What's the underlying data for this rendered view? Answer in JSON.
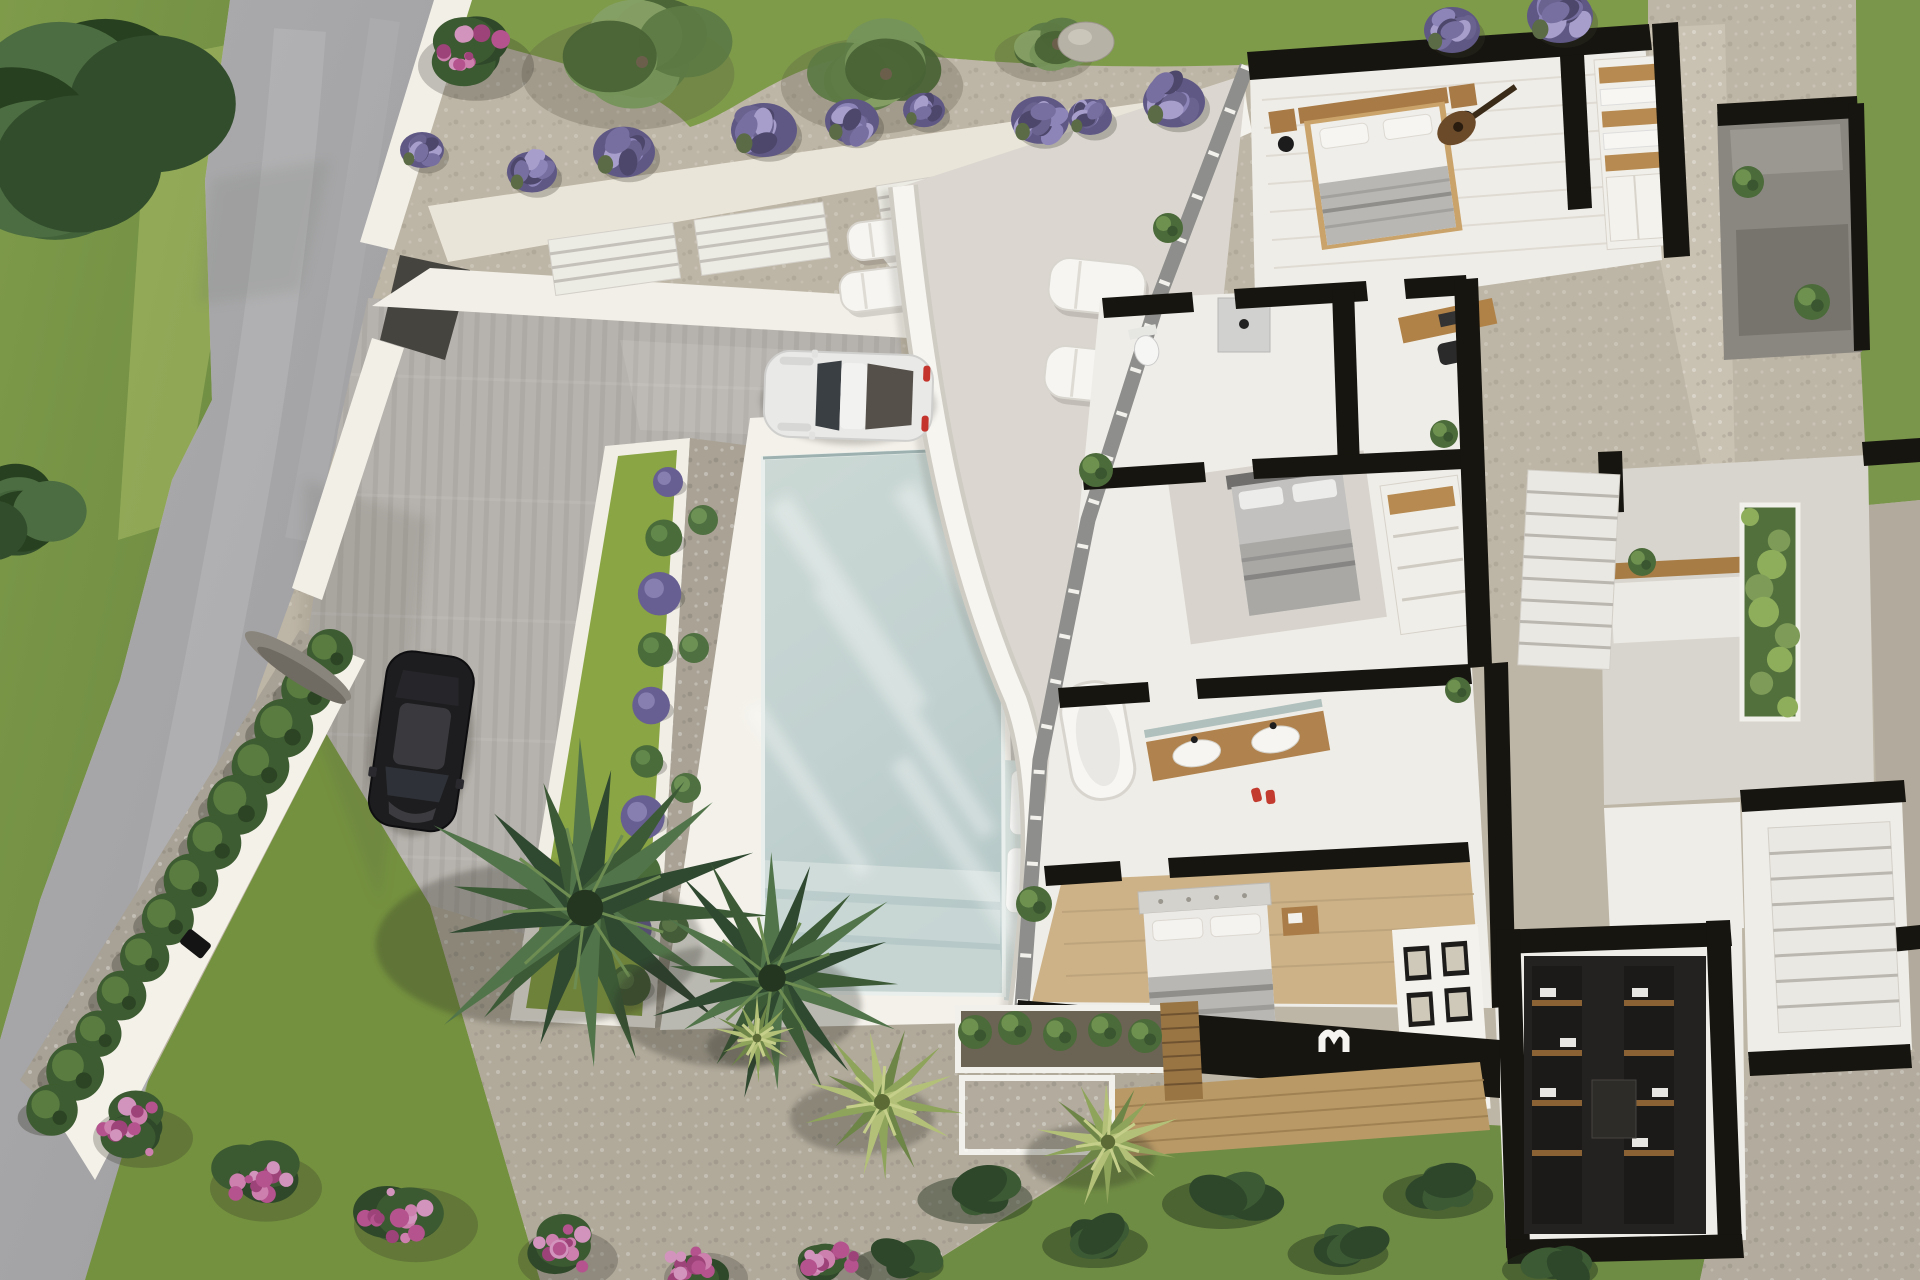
{
  "scene": {
    "description": "Top-down aerial 3D architectural render of a modern white villa with cutaway roof showing the interior floor plan, a rectangular pool, driveway with two parked cars, curved terrace wall, stone paths, lavender rows, cypress hedge, bougainvillea and palm trees",
    "view": "top-down aerial",
    "lighting": "warm daylight from upper right"
  },
  "palette": {
    "grass": "#7d9a48",
    "grass_dark": "#64813b",
    "grass_light": "#a9bd62",
    "road": "#a6a6a8",
    "road_light": "#b9b9bb",
    "gravel_top": "#c0b8a6",
    "gravel_dark": "#a49d8e",
    "white_path": "#eae5d9",
    "driveway": "#b6b2ad",
    "deck": "#f3f1ea",
    "pool_water": "#c9d7d4",
    "pool_deep": "#b8cac9",
    "pool_shelf": "#d3dedb",
    "wall_white": "#f7f5f0",
    "wall_black": "#17150f",
    "terrace": "#dbd7d0",
    "terrace_gray": "#c2bfb9",
    "stone_terrace": "#c9c1b1",
    "house_floor": "#efede8",
    "wood": "#b08350",
    "wood_deck": "#b99a66",
    "closet_dark": "#242220",
    "lavender": "#6f6792",
    "lavender_light": "#8d84b8",
    "hedge_green": "#3d5c31",
    "flower_pink": "#b4538e",
    "palm_green": "#3c5a36",
    "fan_palm": "#8ea45a",
    "car_white": "#e9e9e7",
    "car_black": "#1d1d1f",
    "taillight_red": "#c4342c"
  },
  "vegetation": {
    "lavender_row": [
      {
        "x": 422,
        "y": 150,
        "r": 22
      },
      {
        "x": 532,
        "y": 172,
        "r": 25
      },
      {
        "x": 624,
        "y": 152,
        "r": 31
      },
      {
        "x": 764,
        "y": 130,
        "r": 33
      },
      {
        "x": 852,
        "y": 121,
        "r": 27
      },
      {
        "x": 924,
        "y": 110,
        "r": 21
      },
      {
        "x": 1040,
        "y": 120,
        "r": 29
      },
      {
        "x": 1090,
        "y": 117,
        "r": 22
      },
      {
        "x": 1174,
        "y": 102,
        "r": 31
      },
      {
        "x": 1452,
        "y": 30,
        "r": 28
      },
      {
        "x": 1560,
        "y": 16,
        "r": 33
      }
    ],
    "hedge_row": {
      "x1": 330,
      "y1": 652,
      "x2": 52,
      "y2": 1110,
      "n": 13,
      "r": 27
    },
    "flower_clusters": [
      {
        "x": 468,
        "y": 56,
        "r": 58
      },
      {
        "x": 135,
        "y": 1128,
        "r": 50
      },
      {
        "x": 258,
        "y": 1178,
        "r": 56
      },
      {
        "x": 408,
        "y": 1215,
        "r": 62
      },
      {
        "x": 560,
        "y": 1250,
        "r": 50
      },
      {
        "x": 698,
        "y": 1268,
        "r": 42
      },
      {
        "x": 826,
        "y": 1260,
        "r": 38
      }
    ],
    "olive_trees": [
      {
        "x": 642,
        "y": 62,
        "r": 112
      },
      {
        "x": 886,
        "y": 74,
        "r": 96
      },
      {
        "x": 1058,
        "y": 44,
        "r": 52
      }
    ],
    "corner_trees": [
      {
        "x": 72,
        "y": 148,
        "r": 208
      },
      {
        "x": 18,
        "y": 520,
        "r": 92
      }
    ],
    "dark_palms": [
      {
        "x": 585,
        "y": 908,
        "r": 182
      },
      {
        "x": 772,
        "y": 978,
        "r": 138
      }
    ],
    "fan_palms": [
      {
        "x": 882,
        "y": 1102,
        "r": 80
      },
      {
        "x": 1108,
        "y": 1142,
        "r": 72
      },
      {
        "x": 757,
        "y": 1038,
        "r": 44
      }
    ],
    "pool_bush_row": {
      "x1": 668,
      "y1": 482,
      "x2": 630,
      "y2": 985,
      "n": 10
    },
    "side_bushes": [
      {
        "x": 703,
        "y": 520
      },
      {
        "x": 694,
        "y": 648
      },
      {
        "x": 686,
        "y": 788
      },
      {
        "x": 674,
        "y": 928
      }
    ],
    "dark_bushes": [
      {
        "x": 985,
        "y": 1192,
        "r": 48
      },
      {
        "x": 1105,
        "y": 1238,
        "r": 44
      },
      {
        "x": 1232,
        "y": 1196,
        "r": 50
      },
      {
        "x": 1348,
        "y": 1246,
        "r": 42
      },
      {
        "x": 1448,
        "y": 1188,
        "r": 46
      },
      {
        "x": 908,
        "y": 1258,
        "r": 38
      },
      {
        "x": 1560,
        "y": 1262,
        "r": 40
      }
    ],
    "planter_plants": [
      {
        "x": 975,
        "y": 1032
      },
      {
        "x": 1015,
        "y": 1028
      },
      {
        "x": 1060,
        "y": 1034
      },
      {
        "x": 1105,
        "y": 1030
      },
      {
        "x": 1145,
        "y": 1036
      }
    ],
    "interior_plants": [
      {
        "x": 1096,
        "y": 470,
        "r": 17
      },
      {
        "x": 1444,
        "y": 434,
        "r": 14
      },
      {
        "x": 1034,
        "y": 904,
        "r": 18
      },
      {
        "x": 1458,
        "y": 690,
        "r": 13
      },
      {
        "x": 1748,
        "y": 182,
        "r": 16
      },
      {
        "x": 1812,
        "y": 302,
        "r": 18
      },
      {
        "x": 1642,
        "y": 562,
        "r": 14
      },
      {
        "x": 1168,
        "y": 228,
        "r": 15
      }
    ],
    "green_strip": {
      "x": 1742,
      "y": 505,
      "w": 56,
      "h": 214,
      "n": 9
    }
  },
  "objects": {
    "white_car": {
      "label": "white sports coupe parked on driveway",
      "x": 766,
      "y": 350,
      "w": 168,
      "h": 86,
      "rot": 2
    },
    "black_car": {
      "label": "black sedan parked on lower driveway",
      "x": 390,
      "y": 648,
      "w": 88,
      "h": 176,
      "rot": 8
    },
    "pool_mats": [
      {
        "x": 1012,
        "y": 770,
        "w": 80,
        "h": 64,
        "rot": 2
      },
      {
        "x": 1008,
        "y": 848,
        "w": 82,
        "h": 64,
        "rot": 2
      }
    ],
    "terrace_loungers": [
      {
        "x": 1052,
        "y": 256,
        "w": 96,
        "h": 52,
        "rot": 6
      },
      {
        "x": 1048,
        "y": 344,
        "w": 96,
        "h": 52,
        "rot": 6
      }
    ],
    "terrace_table": {
      "x": 1112,
      "y": 328
    },
    "deck_loungers": [
      {
        "x": 846,
        "y": 224,
        "w": 78,
        "h": 38,
        "rot": -7
      },
      {
        "x": 838,
        "y": 274,
        "w": 80,
        "h": 40,
        "rot": -7
      }
    ],
    "deck_table": {
      "x": 906,
      "y": 258
    },
    "side_planters": [
      {
        "x": 1040,
        "y": 532
      },
      {
        "x": 1036,
        "y": 622
      },
      {
        "x": 1028,
        "y": 792
      }
    ],
    "wall_lamp": {
      "x": 190,
      "y": 928
    },
    "fallen_log": {
      "x": 298,
      "y": 666
    },
    "rock": {
      "x": 1086,
      "y": 42
    }
  },
  "structures": {
    "steps": [
      {
        "x": 548,
        "y": 240,
        "w": 126,
        "h": 56,
        "rot": -8,
        "n": 4,
        "kind": "garden"
      },
      {
        "x": 694,
        "y": 220,
        "w": 130,
        "h": 56,
        "rot": -8,
        "n": 4,
        "kind": "garden"
      },
      {
        "x": 876,
        "y": 186,
        "w": 200,
        "h": 62,
        "rot": -9,
        "n": 5,
        "kind": "garden"
      },
      {
        "x": 1680,
        "y": 110,
        "w": 165,
        "h": 120,
        "rot": -4,
        "n": 5,
        "kind": "stone"
      },
      {
        "x": 1528,
        "y": 470,
        "w": 92,
        "h": 195,
        "rot": 3,
        "n": 9,
        "kind": "stair"
      },
      {
        "x": 1768,
        "y": 828,
        "w": 122,
        "h": 205,
        "rot": -3,
        "n": 8,
        "kind": "stair"
      }
    ],
    "rooms": [
      "bedroom-1 with wood-frame double bed, nightstands, lamps and guitar",
      "wardrobe room with wooden shelving",
      "bathroom with toilet and walk-in shower",
      "study nook with wooden desk",
      "master bedroom with gray upholstered bed and carpet",
      "master bathroom with freestanding tub and double wood vanity",
      "bedroom-2 with tufted headboard bed, striped blanket and picture wall",
      "walk-in closet with dark shelving",
      "two white staircases",
      "gray courtyard with vertical garden",
      "stone roof terraces"
    ]
  }
}
